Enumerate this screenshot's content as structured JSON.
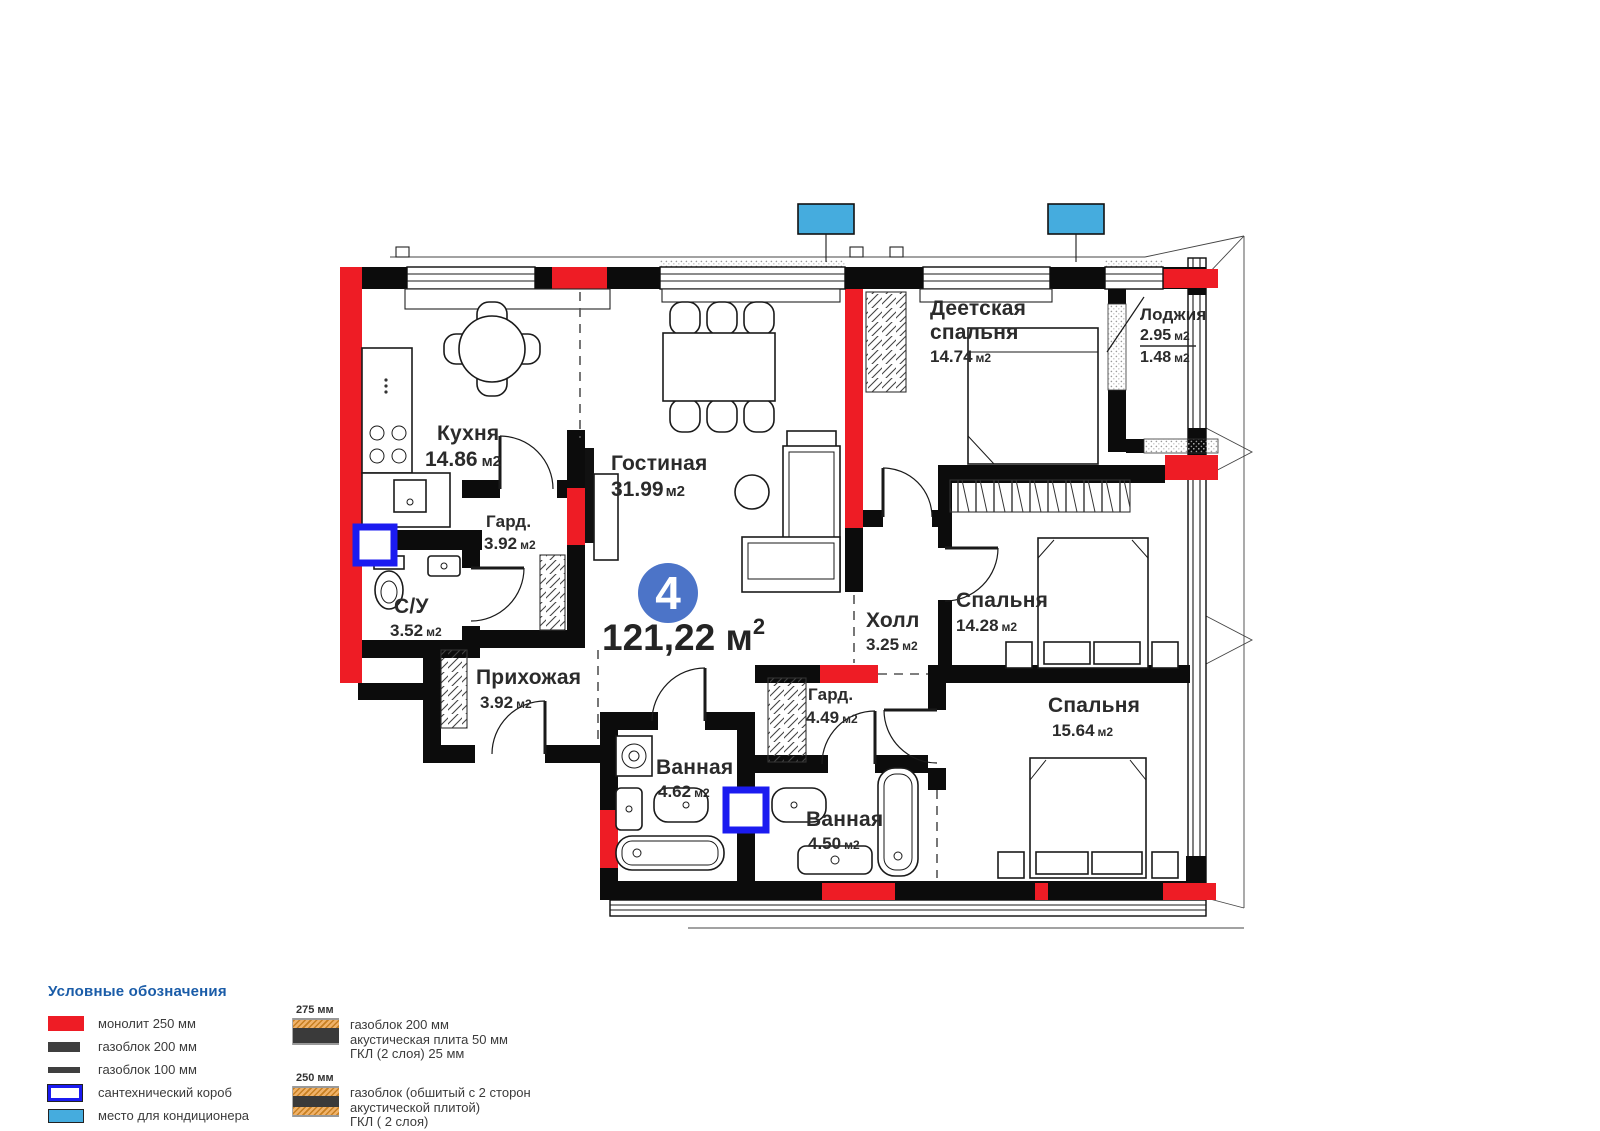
{
  "plan": {
    "unit_number": "4",
    "total_area_value": "121,22",
    "total_area_unit": " м",
    "total_area_sup": "2"
  },
  "rooms": [
    {
      "id": "kitchen",
      "name": "Кухня",
      "area_value": "14.86",
      "area_unit": "м2"
    },
    {
      "id": "living",
      "name": "Гостиная",
      "area_value": "31.99",
      "area_unit": "м2"
    },
    {
      "id": "wardrobe-1",
      "name": "Гард.",
      "area_value": "3.92",
      "area_unit": "м2"
    },
    {
      "id": "wc",
      "name": "С/У",
      "area_value": "3.52",
      "area_unit": "м2"
    },
    {
      "id": "hallway",
      "name": "Прихожая",
      "area_value": "3.92",
      "area_unit": "м2"
    },
    {
      "id": "kids-bedroom",
      "name_line1": "Деетская",
      "name_line2": "спальня",
      "area_value": "14.74",
      "area_unit": "м2"
    },
    {
      "id": "loggia",
      "name": "Лоджия",
      "area_full_value": "2.95",
      "area_full_unit": "м2",
      "area_half_value": "1.48",
      "area_half_unit": "м2"
    },
    {
      "id": "hall",
      "name": "Холл",
      "area_value": "3.25",
      "area_unit": "м2"
    },
    {
      "id": "bedroom-1",
      "name": "Спальня",
      "area_value": "14.28",
      "area_unit": "м2"
    },
    {
      "id": "bedroom-2",
      "name": "Спальня",
      "area_value": "15.64",
      "area_unit": "м2"
    },
    {
      "id": "wardrobe-2",
      "name": "Гард.",
      "area_value": "4.49",
      "area_unit": "м2"
    },
    {
      "id": "bathroom-1",
      "name": "Ванная",
      "area_value": "4.62",
      "area_unit": "м2"
    },
    {
      "id": "bathroom-2",
      "name": "Ванная",
      "area_value": "4.50",
      "area_unit": "м2"
    }
  ],
  "legend": {
    "title": "Условные обозначения",
    "items": [
      {
        "label": "монолит 250 мм",
        "type": "monolith"
      },
      {
        "label": "газоблок 200 мм",
        "type": "gas200"
      },
      {
        "label": "газоблок 100 мм",
        "type": "gas100"
      },
      {
        "label": "сантехнический короб",
        "type": "sanbox"
      },
      {
        "label": "место для кондиционера",
        "type": "ac"
      }
    ],
    "wall_sections": [
      {
        "size": "275 мм",
        "lines": [
          "газоблок 200 мм",
          "акустическая плита 50 мм",
          "ГКЛ (2 слоя) 25 мм"
        ]
      },
      {
        "size": "250 мм",
        "lines": [
          "газоблок (обшитый с 2 сторон",
          "акустической плитой)",
          "ГКЛ ( 2 слоя)"
        ]
      }
    ]
  },
  "colors": {
    "monolith": "#ee1c25",
    "wall": "#0c0c0c",
    "ac": "#45acde",
    "sanitary": "#1b1bf0",
    "badge": "#4c74c8",
    "legend_title": "#1a5ca8",
    "text": "#2b2b2b",
    "acoustic": "#e8a33c"
  }
}
